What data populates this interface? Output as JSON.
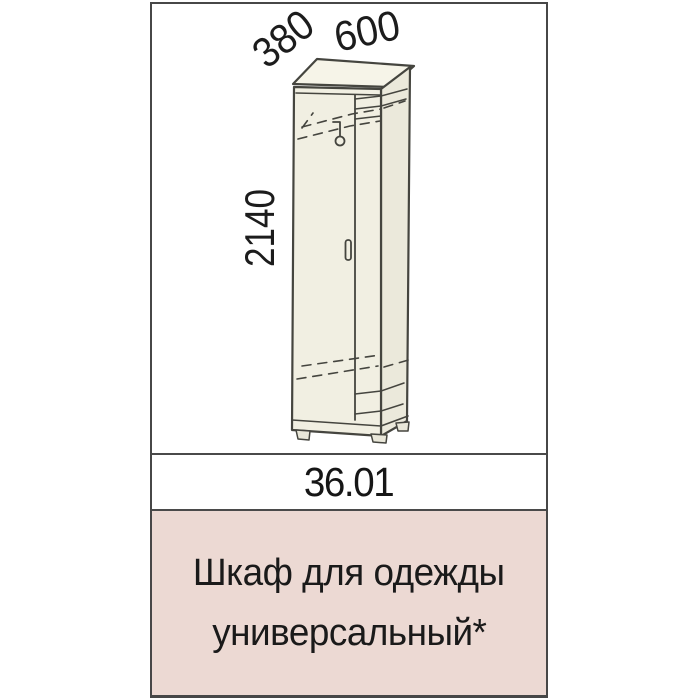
{
  "item_card": {
    "code": "36.01",
    "name_line_1": "Шкаф для одежды",
    "name_line_2": "универсальный*",
    "colors": {
      "name_band_bg": "#ecd9d3",
      "frame_border": "#474747",
      "drawing_line": "#45453f",
      "furniture_fill": "#f1efe2",
      "text": "#1a1a1a"
    }
  },
  "diagram": {
    "dimension_depth_mm": "380",
    "dimension_width_mm": "600",
    "dimension_height_mm": "2140"
  }
}
